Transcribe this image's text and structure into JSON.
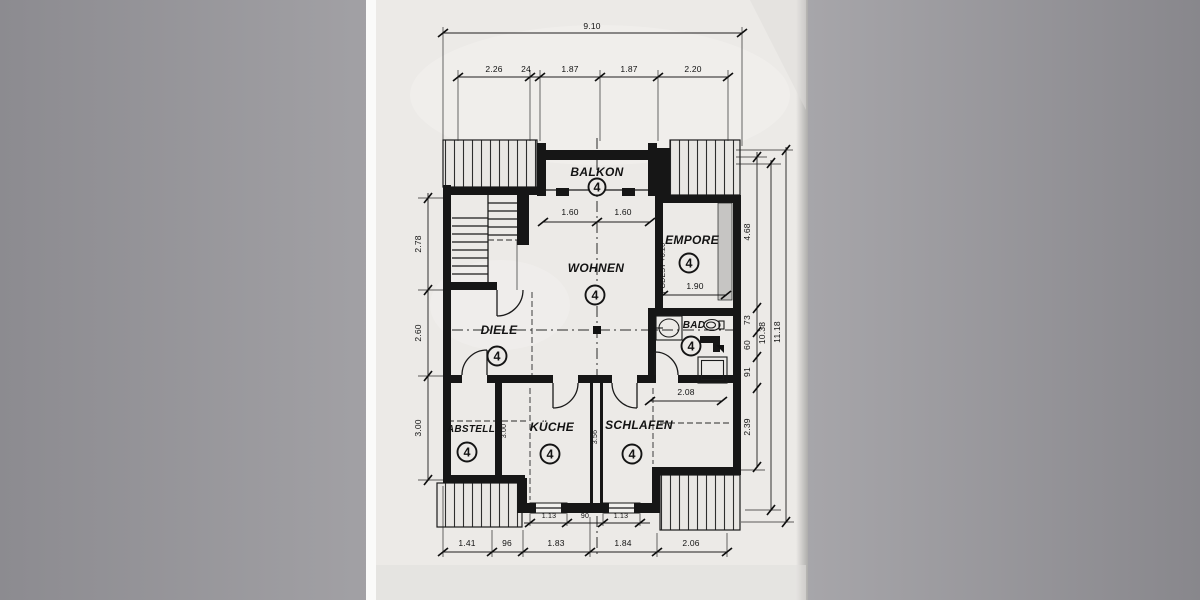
{
  "rooms": {
    "balkon": {
      "name": "BALKON",
      "num": "4"
    },
    "wohnen": {
      "name": "WOHNEN",
      "num": "4"
    },
    "empore": {
      "name": "EMPORE",
      "num": "4"
    },
    "diele": {
      "name": "DIELE",
      "num": "4"
    },
    "bad": {
      "name": "BAD",
      "num": "4"
    },
    "abstell": {
      "name": "ABSTELL",
      "num": "4"
    },
    "kueche": {
      "name": "KÜCHE",
      "num": "4"
    },
    "schlafen": {
      "name": "SCHLAFEN",
      "num": "4"
    }
  },
  "notes": {
    "podest": "PODEST +0.20"
  },
  "dims": {
    "top_total": "9.10",
    "top": [
      "2.26",
      "24",
      "1.87",
      "1.87",
      "2.20"
    ],
    "balkon": [
      "1.60",
      "1.60"
    ],
    "left": [
      "2.78",
      "2.60",
      "3.00"
    ],
    "right": [
      "4.68",
      "73",
      "60",
      "91",
      "2.39"
    ],
    "right_mid": "10.38",
    "right_total": "11.18",
    "empore_w": "1.90",
    "bad_w": "2.08",
    "wall_kueche_left": "3.00",
    "wall_kueche_right": "3.56",
    "windows": [
      "1.13",
      "90",
      "1.13"
    ],
    "bottom": [
      "1.41",
      "96",
      "1.83",
      "1.84",
      "2.06"
    ]
  },
  "colors": {
    "paper": "#eceae7",
    "ink": "#161616",
    "background": "#919095"
  }
}
